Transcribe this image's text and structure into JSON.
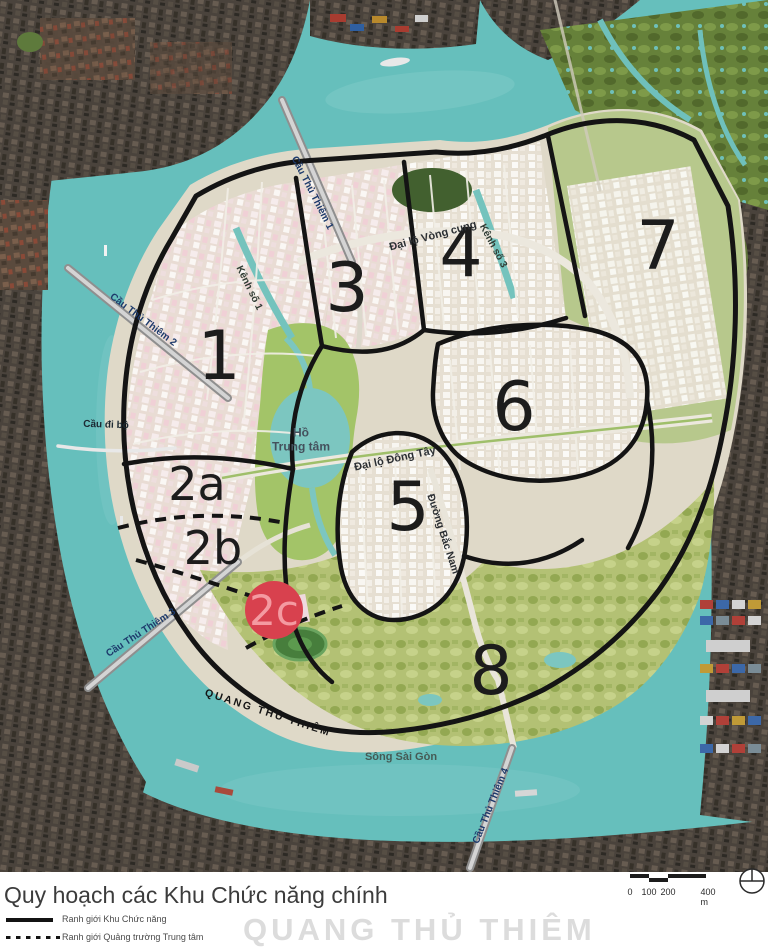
{
  "map": {
    "zone_labels": {
      "z1": "1",
      "z2a": "2a",
      "z2b": "2b",
      "z3": "3",
      "z4": "4",
      "z5": "5",
      "z6": "6",
      "z7": "7",
      "z8": "8"
    },
    "highlight": {
      "label": "2c",
      "circle_color": "#d8414e",
      "label_color": "#f49aa1"
    },
    "labels": {
      "bridge1": "Cầu Thủ Thiêm 1",
      "bridge2": "Cầu Thủ Thiêm 2",
      "pedestrian_bridge": "Cầu đi bộ",
      "bridge3": "Cầu Thủ Thiêm 3",
      "bridge4": "Cầu Thủ Thiêm 4",
      "canal1": "Kênh số 1",
      "canal3": "Kênh số 3",
      "arc_boulevard": "Đại lộ Vòng cung",
      "east_west_boulevard": "Đại lộ Đông Tây",
      "north_south_road": "Đường Bắc Nam",
      "lake_line1": "Hồ",
      "lake_line2": "Trung tâm",
      "river": "Sông Sài Gòn",
      "watermark": "QUANG THỦ THIÊM"
    },
    "colors": {
      "water": "#66bfbc",
      "land": "#dfd9c8",
      "boundary": "#141414",
      "highlight": "#d8414e"
    }
  },
  "footer": {
    "title": "Quy hoạch các Khu Chức năng chính",
    "legend": [
      {
        "style": "solid",
        "label": "Ranh giới Khu Chức năng"
      },
      {
        "style": "dashed",
        "label": "Ranh giới Quảng trường Trung tâm"
      }
    ],
    "scale_bar": {
      "labels": [
        "0",
        "100",
        "200",
        "400 m"
      ]
    },
    "watermark": "QUANG THỦ THIÊM"
  }
}
